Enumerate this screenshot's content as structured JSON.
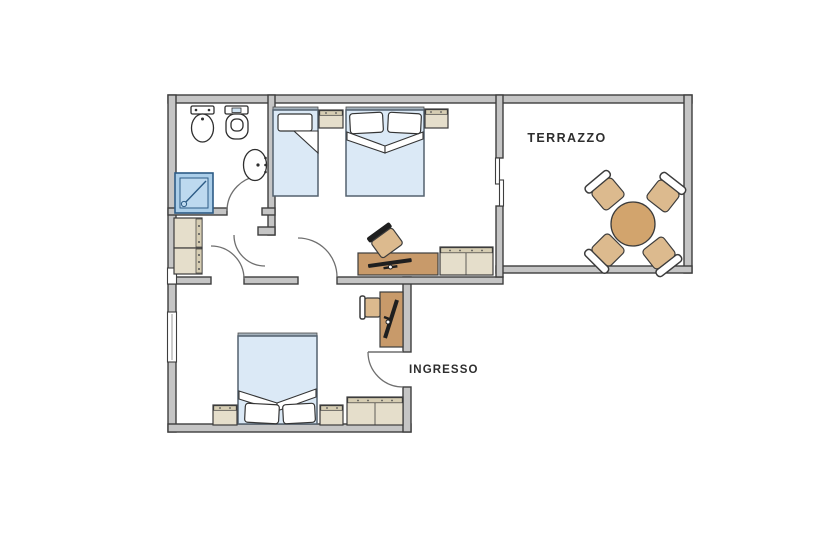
{
  "plan": {
    "labels": {
      "terrace": "TERRAZZO",
      "entrance": "INGRESSO"
    },
    "colors": {
      "wall_fill": "#c5c5c5",
      "wall_stroke": "#3e3e3e",
      "arc": "#6f6f6f",
      "bed_fill": "#dbe9f6",
      "bed_stroke": "#53616f",
      "headboard": "#a5b2bc",
      "beige": "#e5decb",
      "beige_dark": "#d6cdb3",
      "wood": "#c89a6a",
      "tan": "#dcba8e",
      "table": "#d2a46d",
      "shower_fill": "#abcee9",
      "shower_inner": "#bdd9ef",
      "shower_stroke": "#2d5c86",
      "glass": "#cfe3f2",
      "laptop": "#1f1f1f",
      "label": "#2e2e2e"
    },
    "rooms": [
      {
        "name": "bathroom",
        "furniture": [
          "bidet",
          "toilet",
          "wall-sink",
          "shower"
        ]
      },
      {
        "name": "bedroom-top",
        "furniture": [
          "single-bed",
          "nightstand",
          "double-bed",
          "nightstand",
          "desk",
          "desk-chair",
          "dresser"
        ]
      },
      {
        "name": "terrace",
        "furniture": [
          "round-table",
          "chair",
          "chair",
          "chair",
          "chair"
        ]
      },
      {
        "name": "hallway",
        "furniture": [
          "wardrobe"
        ]
      },
      {
        "name": "bedroom-bottom",
        "furniture": [
          "double-bed",
          "nightstand",
          "nightstand",
          "bench",
          "desk",
          "desk-chair"
        ]
      }
    ]
  }
}
